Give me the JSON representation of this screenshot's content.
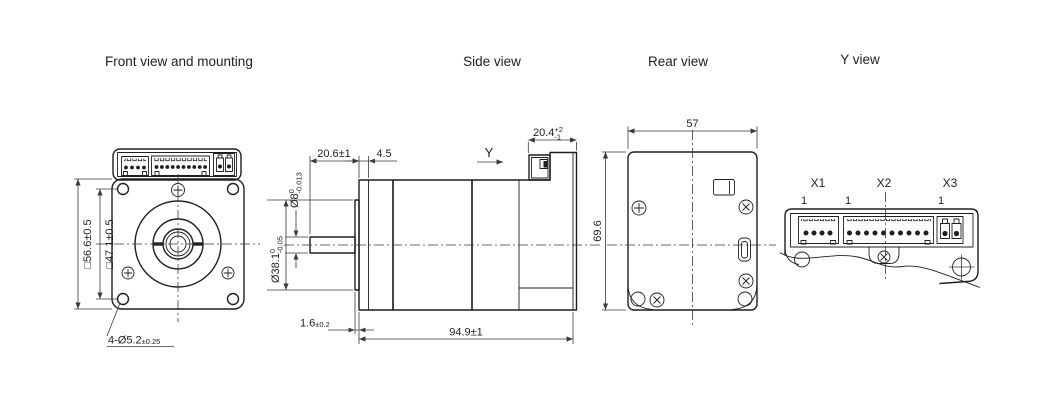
{
  "colors": {
    "line": "#1f1f1f",
    "dimension_line": "#3a3a3a",
    "background": "#ffffff"
  },
  "views": {
    "front": {
      "title": "Front view and mounting",
      "dim_outer_square": "□56.6±0.5",
      "dim_bolt_square": "□47.1±0.5",
      "dim_mounting_holes": "4-Ø5.2",
      "dim_mounting_holes_tol": "±0.25",
      "connector_pins": [
        4,
        10,
        2
      ]
    },
    "side": {
      "title": "Side view",
      "dim_shaft_length": "20.6±1",
      "dim_boss_offset": "4.5",
      "dim_shaft_dia": "Ø8",
      "dim_shaft_dia_tol_upper": "0",
      "dim_shaft_dia_tol_lower": "-0.013",
      "dim_pilot_dia": "Ø38.1",
      "dim_pilot_dia_tol_upper": "0",
      "dim_pilot_dia_tol_lower": "-0.05",
      "dim_pilot_thickness": "1.6",
      "dim_pilot_thickness_tol": "±0.2",
      "dim_total_length": "94.9±1",
      "dim_connector_depth": "20.4",
      "dim_connector_depth_tol_upper": "+2",
      "dim_connector_depth_tol_lower": "-1",
      "view_direction_label": "Y"
    },
    "rear": {
      "title": "Rear view",
      "dim_width": "57",
      "dim_height": "69.6"
    },
    "y_view": {
      "title": "Y view",
      "connectors": [
        {
          "label": "X1",
          "pin_marker": "1",
          "pins": 4
        },
        {
          "label": "X2",
          "pin_marker": "1",
          "pins": 10
        },
        {
          "label": "X3",
          "pin_marker": "1",
          "pins": 2
        }
      ]
    }
  }
}
